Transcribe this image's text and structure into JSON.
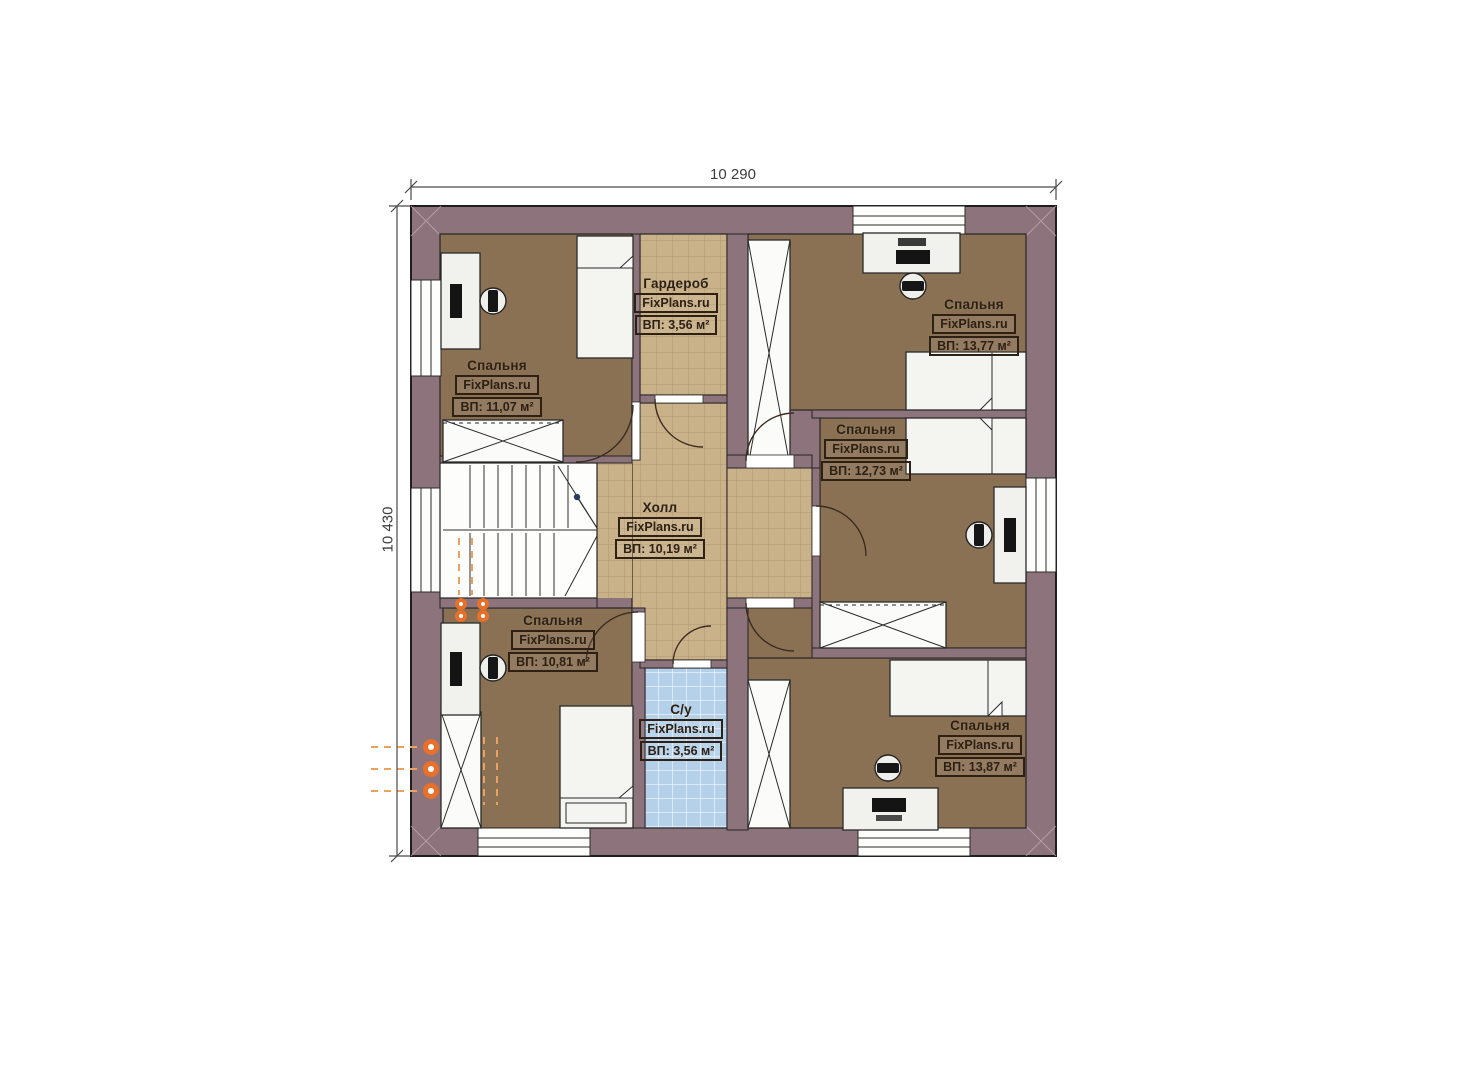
{
  "dimensions": {
    "width_label": "10 290",
    "height_label": "10 430"
  },
  "rooms": {
    "bedroom_tl": {
      "name": "Спальня",
      "brand": "FixPlans.ru",
      "area": "ВП: 11,07 м²"
    },
    "garderob": {
      "name": "Гардероб",
      "brand": "FixPlans.ru",
      "area": "ВП: 3,56 м²"
    },
    "bedroom_tr": {
      "name": "Спальня",
      "brand": "FixPlans.ru",
      "area": "ВП: 13,77 м²"
    },
    "bedroom_mr": {
      "name": "Спальня",
      "brand": "FixPlans.ru",
      "area": "ВП: 12,73 м²"
    },
    "hall": {
      "name": "Холл",
      "brand": "FixPlans.ru",
      "area": "ВП: 10,19 м²"
    },
    "bedroom_bl": {
      "name": "Спальня",
      "brand": "FixPlans.ru",
      "area": "ВП: 10,81 м²"
    },
    "bathroom": {
      "name": "С/у",
      "brand": "FixPlans.ru",
      "area": "ВП: 3,56 м²"
    },
    "bedroom_br": {
      "name": "Спальня",
      "brand": "FixPlans.ru",
      "area": "ВП: 13,87 м²"
    }
  },
  "colors": {
    "wall": "#8d747c",
    "bedroom_floor": "#8a7154",
    "hall_floor": "#c9b189",
    "bath_floor": "#b5d1ea",
    "accent_orange": "#e8702a"
  }
}
